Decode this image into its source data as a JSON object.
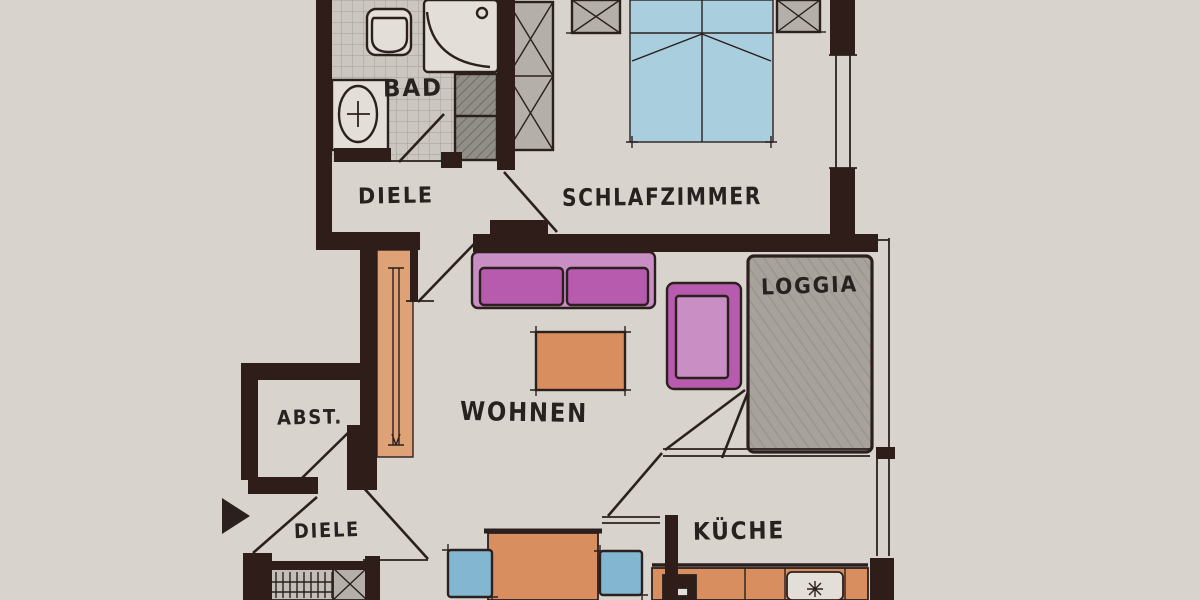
{
  "title": "Grundriss Wohnung (Handzeichnung)",
  "colors": {
    "paper": "#d8d4cd",
    "wall": "#2f1d1a",
    "ink": "#2b201e",
    "label": "#27211f",
    "tile_bg": "#cbc7c0",
    "tile_line": "#a39f98",
    "fixture": "#e3dfd8",
    "gray_fill": "#b4b0a9",
    "gray_dark": "#918d87",
    "loggia_gray": "#a7a39c",
    "bed_blue": "#a9cede",
    "chair_blue": "#83b6d1",
    "sofa_light": "#c98fc4",
    "sofa_dark": "#b65bae",
    "orange": "#d98e5f",
    "orange_light": "#dfa276"
  },
  "rooms": {
    "bad": {
      "label": "BAD"
    },
    "diele_upper": {
      "label": "DIELE"
    },
    "schlafzimmer": {
      "label": "SCHLAFZIMMER"
    },
    "loggia": {
      "label": "LOGGIA"
    },
    "wohnen": {
      "label": "WOHNEN"
    },
    "abst": {
      "label": "ABST."
    },
    "diele_lower": {
      "label": "DIELE"
    },
    "kueche": {
      "label": "KÜCHE"
    }
  }
}
